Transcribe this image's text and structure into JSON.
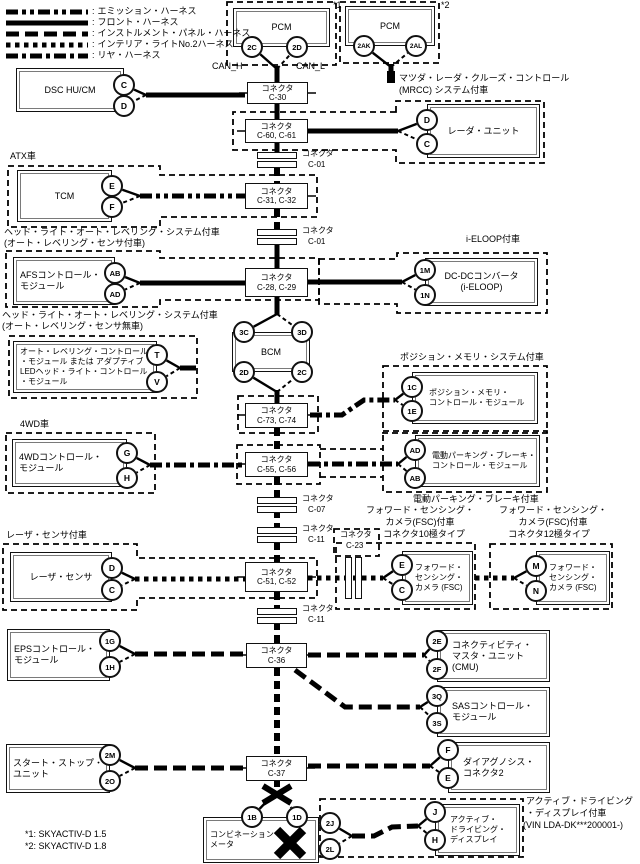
{
  "colors": {
    "ink": "#000000",
    "background": "#ffffff"
  },
  "legend": {
    "separator": ":",
    "items": [
      {
        "id": "emission",
        "label": "エミッション・ハーネス"
      },
      {
        "id": "front",
        "label": "フロント・ハーネス"
      },
      {
        "id": "instrument",
        "label": "インストルメント・パネル・ハーネス"
      },
      {
        "id": "interior",
        "label": "インテリア・ライトNo.2ハーネス"
      },
      {
        "id": "rear",
        "label": "リヤ・ハーネス"
      }
    ]
  },
  "devices": {
    "pcm1": {
      "lines": [
        "PCM"
      ],
      "pins": [
        "2C",
        "2D"
      ]
    },
    "pcm2": {
      "lines": [
        "PCM"
      ],
      "pins": [
        "2AK",
        "2AL"
      ]
    },
    "dsc": {
      "lines": [
        "DSC HU/CM"
      ],
      "pins": [
        "C",
        "D"
      ]
    },
    "radar": {
      "lines": [
        "レーダ・ユニット"
      ],
      "pins": [
        "D",
        "C"
      ]
    },
    "tcm": {
      "lines": [
        "TCM"
      ],
      "pins": [
        "E",
        "F"
      ]
    },
    "afs": {
      "lines": [
        "AFSコントロール・",
        "モジュール"
      ],
      "pins": [
        "AB",
        "AD"
      ]
    },
    "dcdc": {
      "lines": [
        "DC-DCコンバータ",
        "(i-ELOOP)"
      ],
      "pins": [
        "1M",
        "1N"
      ]
    },
    "autolevel": {
      "lines": [
        "オート・レベリング・コントロール",
        "・モジュール または アダプティブ",
        "LEDヘッド・ライト・コントロール",
        "・モジュール"
      ],
      "pins": [
        "T",
        "V"
      ]
    },
    "bcm": {
      "lines": [
        "BCM"
      ],
      "pins": [
        "3C",
        "3D",
        "2D",
        "2C"
      ]
    },
    "posmem": {
      "lines": [
        "ポジション・メモリ・",
        "コントロール・モジュール"
      ],
      "pins": [
        "1C",
        "1E"
      ]
    },
    "fourwd": {
      "lines": [
        "4WDコントロール・",
        "モジュール"
      ],
      "pins": [
        "G",
        "H"
      ]
    },
    "park": {
      "lines": [
        "電動パーキング・ブレーキ・",
        "コントロール・モジュール"
      ],
      "pins": [
        "AD",
        "AB"
      ]
    },
    "laser": {
      "lines": [
        "レーザ・センサ"
      ],
      "pins": [
        "D",
        "C"
      ]
    },
    "fsc1": {
      "lines": [
        "フォワード・",
        "センシング・",
        "カメラ (FSC)"
      ],
      "pins": [
        "E",
        "C"
      ]
    },
    "fsc2": {
      "lines": [
        "フォワード・",
        "センシング・",
        "カメラ (FSC)"
      ],
      "pins": [
        "M",
        "N"
      ]
    },
    "eps": {
      "lines": [
        "EPSコントロール・",
        "モジュール"
      ],
      "pins": [
        "1G",
        "1H"
      ]
    },
    "cmu": {
      "lines": [
        "コネクティビティ・",
        "マスタ・ユニット",
        "(CMU)"
      ],
      "pins": [
        "2E",
        "2F"
      ]
    },
    "sas": {
      "lines": [
        "SASコントロール・",
        "モジュール"
      ],
      "pins": [
        "3Q",
        "3S"
      ]
    },
    "startstop": {
      "lines": [
        "スタート・ストップ・",
        "ユニット"
      ],
      "pins": [
        "2M",
        "2O"
      ]
    },
    "diag": {
      "lines": [
        "ダイアグノシス・",
        "コネクタ2"
      ],
      "pins": [
        "F",
        "E"
      ]
    },
    "meter": {
      "lines": [
        "コンビネーション・",
        "メータ"
      ],
      "pins": [
        "1B",
        "1D",
        "2J",
        "2L"
      ]
    },
    "display": {
      "lines": [
        "アクティブ・",
        "ドライビング・",
        "ディスプレイ"
      ],
      "pins": [
        "J",
        "H"
      ]
    }
  },
  "connectors": {
    "c30": {
      "lines": [
        "コネクタ",
        "C-30"
      ]
    },
    "c6061": {
      "lines": [
        "コネクタ",
        "C-60, C-61"
      ]
    },
    "c3132": {
      "lines": [
        "コネクタ",
        "C-31, C-32"
      ]
    },
    "c2829": {
      "lines": [
        "コネクタ",
        "C-28, C-29"
      ]
    },
    "c7374": {
      "lines": [
        "コネクタ",
        "C-73, C-74"
      ]
    },
    "c5556": {
      "lines": [
        "コネクタ",
        "C-55, C-56"
      ]
    },
    "c5152": {
      "lines": [
        "コネクタ",
        "C-51, C-52"
      ]
    },
    "c36": {
      "lines": [
        "コネクタ",
        "C-36"
      ]
    },
    "c37": {
      "lines": [
        "コネクタ",
        "C-37"
      ]
    },
    "c01a": {
      "lines": [
        "コネクタ",
        "C-01"
      ]
    },
    "c01b": {
      "lines": [
        "コネクタ",
        "C-01"
      ]
    },
    "c07": {
      "lines": [
        "コネクタ",
        "C-07"
      ]
    },
    "c11a": {
      "lines": [
        "コネクタ",
        "C-11"
      ]
    },
    "c11b": {
      "lines": [
        "コネクタ",
        "C-11"
      ]
    },
    "c23": {
      "lines": [
        "コネクタ",
        "C-23"
      ]
    }
  },
  "labels": {
    "sup1": "*1",
    "sup2": "*2",
    "can_h": "CAN_H",
    "can_l": "CAN_L",
    "mrcc1": "マツダ・レーダ・クルーズ・コントロール",
    "mrcc2": "(MRCC) システム付車",
    "atx": "ATX車",
    "afs1": "ヘッド・ライト・オート・レベリング・システム付車",
    "afs2": "(オート・レベリング・センサ付車)",
    "ieloop": "i-ELOOP付車",
    "al1": "ヘッド・ライト・オート・レベリング・システム付車",
    "al2": "(オート・レベリング・センサ無車)",
    "posmem": "ポジション・メモリ・システム付車",
    "fourwd": "4WD車",
    "park": "電動パーキング・ブレーキ付車",
    "laser": "レーザ・センサ付車",
    "fsc10_1": "フォワード・センシング・",
    "fsc10_2": "カメラ(FSC)付車",
    "fsc10_3": "コネクタ10極タイプ",
    "fsc12_1": "フォワード・センシング・",
    "fsc12_2": "カメラ(FSC)付車",
    "fsc12_3": "コネクタ12極タイプ",
    "disp1": "アクティブ・ドライビング",
    "disp2": "・ディスプレイ付車",
    "disp3": "(VIN LDA-DK***200001-)",
    "note1": "*1: SKYACTIV-D 1.5",
    "note2": "*2: SKYACTIV-D 1.8"
  }
}
